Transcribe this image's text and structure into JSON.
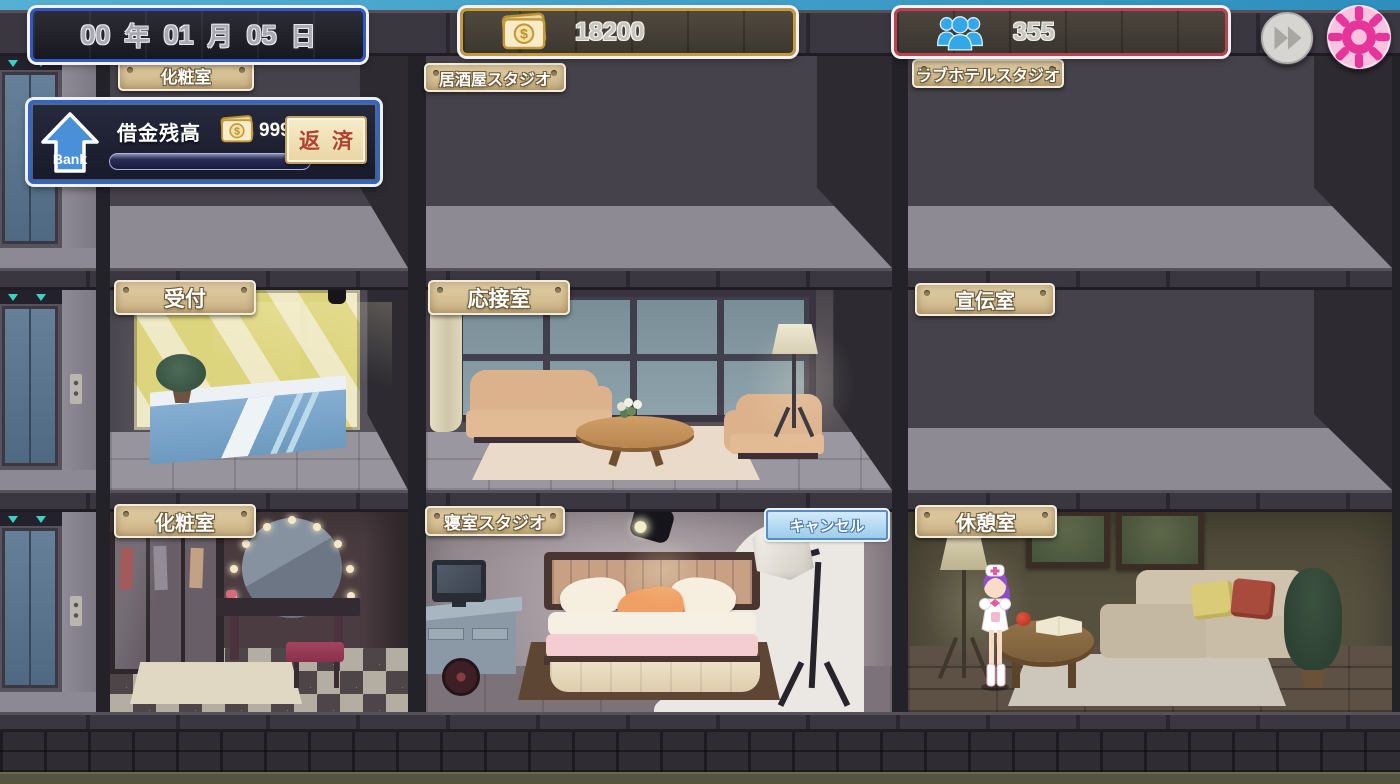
{
  "hud": {
    "date": {
      "year": "00",
      "year_unit": "年",
      "month": "01",
      "month_unit": "月",
      "day": "05",
      "day_unit": "日"
    },
    "money": {
      "value": "18200"
    },
    "population": {
      "value": "355"
    }
  },
  "controls": {
    "cancel_label": "キャンセル"
  },
  "bank": {
    "icon_label": "Bank",
    "title": "借金残高",
    "amount": "99990000",
    "repay_label": "返済",
    "progress_percent": 0
  },
  "floors": [
    {
      "name": "top-floor",
      "rooms": [
        {
          "label": "化粧室"
        },
        {
          "label": "居酒屋スタジオ"
        },
        {
          "label": "ラブホテルスタジオ"
        }
      ]
    },
    {
      "name": "middle-floor",
      "rooms": [
        {
          "label": "受付"
        },
        {
          "label": "応接室"
        },
        {
          "label": "宣伝室"
        }
      ]
    },
    {
      "name": "bottom-floor",
      "rooms": [
        {
          "label": "化粧室"
        },
        {
          "label": "寝室スタジオ"
        },
        {
          "label": "休憩室"
        }
      ]
    }
  ],
  "icons": {
    "money_symbol": "$",
    "money": "bill-stack-dollar",
    "population": "three-people-group",
    "fast_forward": "double-right-arrows",
    "settings": "gear",
    "bank": "up-arrow-bank",
    "elevator_indicator": "down-triangles"
  },
  "colors": {
    "date_border": "#3257c6",
    "money_border": "#c39a3e",
    "population_border": "#bb4350",
    "settings_pink": "#e6359a",
    "people_blue": "#34a7e8",
    "cancel_fill": "#a9d2ee",
    "sign_fill": "#d6c198",
    "hud_glow": "#f2f2f5",
    "repay_text": "#b04030"
  }
}
